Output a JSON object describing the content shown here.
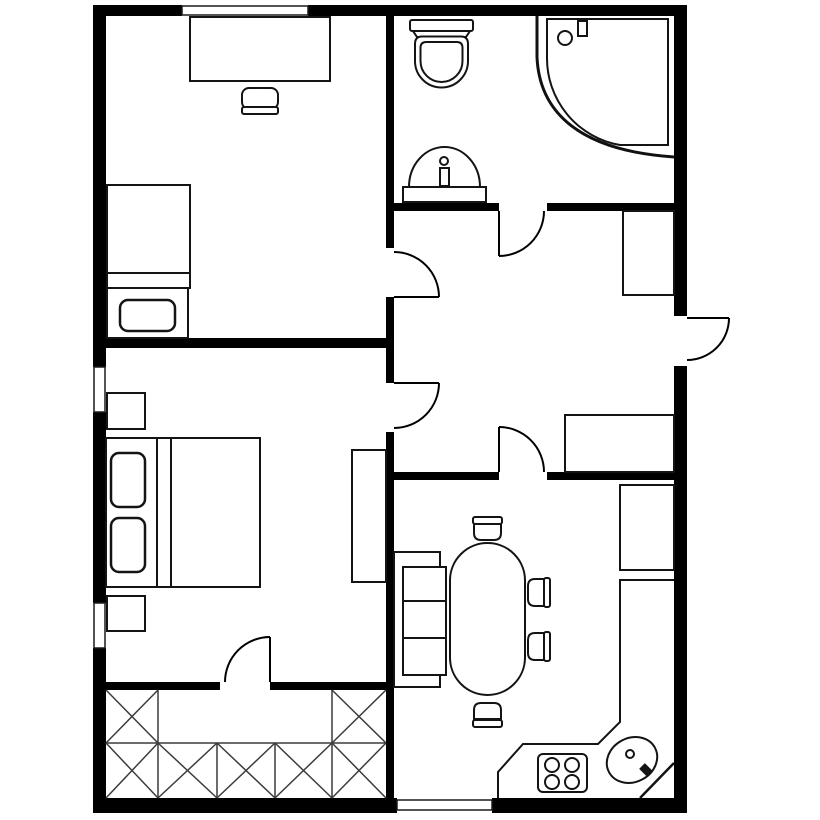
{
  "canvas": {
    "width": 820,
    "height": 820,
    "background": "#ffffff"
  },
  "colors": {
    "wall": "#000000",
    "line": "#141414",
    "hatch": "#3c3c3c",
    "floor": "#ffffff"
  },
  "styles": {
    "wall": {
      "fill": "#000000",
      "stroke": "none"
    },
    "window": {
      "fill": "#ffffff",
      "stroke": "#1a1a1a",
      "sw": 1.5
    },
    "door": {
      "fill": "none",
      "stroke": "#000000",
      "sw": 2
    },
    "furn": {
      "fill": "#ffffff",
      "stroke": "#141414",
      "sw": 2
    },
    "outline": {
      "fill": "none",
      "stroke": "#141414",
      "sw": 2
    },
    "pillow": {
      "fill": "#ffffff",
      "stroke": "#141414",
      "sw": 2.5
    },
    "screen": {
      "fill": "none",
      "stroke": "#111111",
      "sw": 3
    },
    "hatch": {
      "fill": "none",
      "stroke": "#3c3c3c",
      "sw": 1.5
    }
  },
  "shapes": [
    {
      "name": "top-wall-left",
      "type": "rect",
      "style": "wall",
      "x": 93,
      "y": 5,
      "w": 89,
      "h": 11
    },
    {
      "name": "top-wall-right",
      "type": "rect",
      "style": "wall",
      "x": 308,
      "y": 5,
      "w": 379,
      "h": 11
    },
    {
      "name": "bottom-wall-left",
      "type": "rect",
      "style": "wall",
      "x": 93,
      "y": 798,
      "w": 304,
      "h": 15
    },
    {
      "name": "bottom-wall-right",
      "type": "rect",
      "style": "wall",
      "x": 492,
      "y": 798,
      "w": 195,
      "h": 15
    },
    {
      "name": "left-wall-upper",
      "type": "rect",
      "style": "wall",
      "x": 93,
      "y": 5,
      "w": 13,
      "h": 362
    },
    {
      "name": "left-wall-middle",
      "type": "rect",
      "style": "wall",
      "x": 93,
      "y": 412,
      "w": 13,
      "h": 191
    },
    {
      "name": "left-wall-lower",
      "type": "rect",
      "style": "wall",
      "x": 93,
      "y": 648,
      "w": 13,
      "h": 165
    },
    {
      "name": "right-wall-upper",
      "type": "rect",
      "style": "wall",
      "x": 674,
      "y": 5,
      "w": 13,
      "h": 311
    },
    {
      "name": "right-wall-lower",
      "type": "rect",
      "style": "wall",
      "x": 674,
      "y": 366,
      "w": 13,
      "h": 447
    },
    {
      "name": "middle-wall-upper",
      "type": "rect",
      "style": "wall",
      "x": 386,
      "y": 16,
      "w": 8,
      "h": 232
    },
    {
      "name": "middle-wall-mid",
      "type": "rect",
      "style": "wall",
      "x": 386,
      "y": 297,
      "w": 8,
      "h": 86
    },
    {
      "name": "middle-wall-lower",
      "type": "rect",
      "style": "wall",
      "x": 386,
      "y": 432,
      "w": 8,
      "h": 366
    },
    {
      "name": "bedroom-divider-wall",
      "type": "rect",
      "style": "wall",
      "x": 106,
      "y": 338,
      "w": 280,
      "h": 10
    },
    {
      "name": "storage-wall-left",
      "type": "rect",
      "style": "wall",
      "x": 106,
      "y": 682,
      "w": 114,
      "h": 8
    },
    {
      "name": "storage-wall-right",
      "type": "rect",
      "style": "wall",
      "x": 270,
      "y": 682,
      "w": 116,
      "h": 8
    },
    {
      "name": "bathroom-wall-left",
      "type": "rect",
      "style": "wall",
      "x": 386,
      "y": 203,
      "w": 113,
      "h": 8
    },
    {
      "name": "bathroom-wall-right",
      "type": "rect",
      "style": "wall",
      "x": 547,
      "y": 203,
      "w": 127,
      "h": 8
    },
    {
      "name": "kitchen-wall-left",
      "type": "rect",
      "style": "wall",
      "x": 394,
      "y": 472,
      "w": 105,
      "h": 8
    },
    {
      "name": "kitchen-wall-right",
      "type": "rect",
      "style": "wall",
      "x": 547,
      "y": 472,
      "w": 127,
      "h": 8
    },
    {
      "name": "window-top",
      "type": "rect",
      "style": "window",
      "x": 182,
      "y": 6,
      "w": 126,
      "h": 9
    },
    {
      "name": "window-left-upper",
      "type": "rect",
      "style": "window",
      "x": 94,
      "y": 367,
      "w": 11,
      "h": 45
    },
    {
      "name": "window-left-lower",
      "type": "rect",
      "style": "window",
      "x": 94,
      "y": 603,
      "w": 11,
      "h": 45
    },
    {
      "name": "window-bottom",
      "type": "rect",
      "style": "window",
      "x": 397,
      "y": 800,
      "w": 95,
      "h": 10
    },
    {
      "name": "desk",
      "type": "rect",
      "style": "furn",
      "x": 190,
      "y": 17,
      "w": 140,
      "h": 64
    },
    {
      "name": "desk-chair-seat",
      "type": "rect",
      "style": "furn",
      "x": 242,
      "y": 88,
      "w": 36,
      "h": 21,
      "rx": 7
    },
    {
      "name": "desk-chair-back",
      "type": "rect",
      "style": "furn",
      "x": 242,
      "y": 107,
      "w": 36,
      "h": 7,
      "rx": 2
    },
    {
      "name": "single-bed-mattress",
      "type": "rect",
      "style": "furn",
      "x": 107,
      "y": 185,
      "w": 83,
      "h": 88
    },
    {
      "name": "single-bed-fold",
      "type": "rect",
      "style": "furn",
      "x": 107,
      "y": 273,
      "w": 83,
      "h": 15
    },
    {
      "name": "single-bed-head",
      "type": "rect",
      "style": "furn",
      "x": 107,
      "y": 288,
      "w": 81,
      "h": 50
    },
    {
      "name": "single-bed-pillow",
      "type": "rect",
      "style": "pillow",
      "x": 120,
      "y": 300,
      "w": 55,
      "h": 31,
      "rx": 8
    },
    {
      "name": "nightstand-1",
      "type": "rect",
      "style": "furn",
      "x": 107,
      "y": 393,
      "w": 38,
      "h": 36
    },
    {
      "name": "nightstand-2",
      "type": "rect",
      "style": "furn",
      "x": 107,
      "y": 596,
      "w": 38,
      "h": 35
    },
    {
      "name": "double-bed-frame",
      "type": "rect",
      "style": "furn",
      "x": 106,
      "y": 438,
      "w": 154,
      "h": 149
    },
    {
      "name": "double-bed-pillow-1",
      "type": "rect",
      "style": "pillow",
      "x": 111,
      "y": 453,
      "w": 34,
      "h": 54,
      "rx": 8
    },
    {
      "name": "double-bed-pillow-2",
      "type": "rect",
      "style": "pillow",
      "x": 111,
      "y": 518,
      "w": 34,
      "h": 54,
      "rx": 8
    },
    {
      "name": "double-bed-fold-line-1",
      "type": "line",
      "style": "outline",
      "x1": 157,
      "y1": 438,
      "x2": 157,
      "y2": 587
    },
    {
      "name": "double-bed-fold-line-2",
      "type": "line",
      "style": "outline",
      "x1": 171,
      "y1": 438,
      "x2": 171,
      "y2": 587
    },
    {
      "name": "wardrobe",
      "type": "rect",
      "style": "furn",
      "x": 352,
      "y": 450,
      "w": 34,
      "h": 132
    },
    {
      "name": "toilet-tank",
      "type": "rect",
      "style": "furn",
      "x": 410,
      "y": 20,
      "w": 63,
      "h": 11,
      "rx": 2
    },
    {
      "name": "toilet-neck",
      "type": "path",
      "style": "furn",
      "d": "M413,31 L470,31 L466,37 L417,37 Z"
    },
    {
      "name": "toilet-bowl-outer",
      "type": "path",
      "style": "furn",
      "d": "M415,44 Q415,36.5 422,36.5 L461,36.5 Q468,36.5 468,44 L468,61 A26.5,26.5 0 0 1 415,61 Z"
    },
    {
      "name": "toilet-bowl-inner",
      "type": "path",
      "style": "furn",
      "d": "M420.5,48 Q420.5,42 426,42 L457,42 Q462.5,42 462.5,48 L462.5,61 A21,21 0 0 1 420.5,61 Z"
    },
    {
      "name": "bathroom-sink-bowl",
      "type": "path",
      "style": "furn",
      "d": "M409,187 A35.5,40 0 0 1 480,187 Z"
    },
    {
      "name": "bathroom-sink-base",
      "type": "rect",
      "style": "furn",
      "x": 403,
      "y": 187,
      "w": 83,
      "h": 15
    },
    {
      "name": "bathroom-sink-drain",
      "type": "circle",
      "style": "furn",
      "cx": 444,
      "cy": 161,
      "r": 4
    },
    {
      "name": "bathroom-sink-faucet",
      "type": "rect",
      "style": "furn",
      "x": 440,
      "y": 168,
      "w": 9,
      "h": 18
    },
    {
      "name": "shower-screen-side",
      "type": "line",
      "style": "screen",
      "x1": 537,
      "y1": 16,
      "x2": 537,
      "y2": 57
    },
    {
      "name": "shower-screen-arc",
      "type": "path",
      "style": "screen",
      "d": "M537,57 C539,105 570,150 674,157"
    },
    {
      "name": "shower-tray",
      "type": "path",
      "style": "furn",
      "d": "M547,19 L547,57 A88,88 0 0 0 620,145 L668,145 L668,19 Z"
    },
    {
      "name": "shower-drain",
      "type": "circle",
      "style": "furn",
      "cx": 565,
      "cy": 38,
      "r": 7
    },
    {
      "name": "shower-handle",
      "type": "rect",
      "style": "furn",
      "x": 578,
      "y": 21,
      "w": 9,
      "h": 15
    },
    {
      "name": "hall-closet-1",
      "type": "rect",
      "style": "furn",
      "x": 623,
      "y": 211,
      "w": 51,
      "h": 84
    },
    {
      "name": "hall-closet-2",
      "type": "rect",
      "style": "furn",
      "x": 565,
      "y": 415,
      "w": 109,
      "h": 57
    },
    {
      "name": "sofa-back",
      "type": "rect",
      "style": "furn",
      "x": 394,
      "y": 552,
      "w": 46,
      "h": 135
    },
    {
      "name": "sofa-seat",
      "type": "rect",
      "style": "furn",
      "x": 403,
      "y": 567,
      "w": 43,
      "h": 108
    },
    {
      "name": "sofa-cushion-line-1",
      "type": "line",
      "style": "outline",
      "x1": 403,
      "y1": 601,
      "x2": 446,
      "y2": 601
    },
    {
      "name": "sofa-cushion-line-2",
      "type": "line",
      "style": "outline",
      "x1": 403,
      "y1": 638,
      "x2": 446,
      "y2": 638
    },
    {
      "name": "dining-table",
      "type": "rect",
      "style": "furn",
      "x": 450,
      "y": 543,
      "w": 75,
      "h": 152,
      "rx": 37.5
    },
    {
      "name": "chair-top-back",
      "type": "rect",
      "style": "furn",
      "x": 473,
      "y": 517,
      "w": 29,
      "h": 7,
      "rx": 2
    },
    {
      "name": "chair-top-seat",
      "type": "path",
      "style": "furn",
      "d": "M474,524 h27 v9 q0,7 -7,7 h-13 q-7,0 -7,-7 Z"
    },
    {
      "name": "chair-right-1-back",
      "type": "rect",
      "style": "furn",
      "x": 544,
      "y": 578,
      "w": 6,
      "h": 29,
      "rx": 2
    },
    {
      "name": "chair-right-1-seat",
      "type": "path",
      "style": "furn",
      "d": "M544,579 v27 h-9 q-7,0 -7,-7 v-13 q0,-7 7,-7 Z"
    },
    {
      "name": "chair-right-2-back",
      "type": "rect",
      "style": "furn",
      "x": 544,
      "y": 632,
      "w": 6,
      "h": 29,
      "rx": 2
    },
    {
      "name": "chair-right-2-seat",
      "type": "path",
      "style": "furn",
      "d": "M544,633 v27 h-9 q-7,0 -7,-7 v-13 q0,-7 7,-7 Z"
    },
    {
      "name": "chair-bottom-back",
      "type": "rect",
      "style": "furn",
      "x": 473,
      "y": 720,
      "w": 29,
      "h": 7,
      "rx": 2
    },
    {
      "name": "chair-bottom-seat",
      "type": "path",
      "style": "furn",
      "d": "M474,719 v-9 q0,-7 7,-7 h13 q7,0 7,7 v9 Z"
    },
    {
      "name": "kitchen-counter-upper",
      "type": "rect",
      "style": "furn",
      "x": 620,
      "y": 485,
      "w": 54,
      "h": 85
    },
    {
      "name": "kitchen-counter-edge",
      "type": "path",
      "style": "outline",
      "d": "M674,580 L620,580 L620,722 L598,744 L523,744 L498,772 L498,798"
    },
    {
      "name": "kitchen-corner-diagonal",
      "type": "line",
      "style": "outline",
      "x1": 640,
      "y1": 798,
      "x2": 674,
      "y2": 763,
      "sw": 2.5
    },
    {
      "name": "stove",
      "type": "rect",
      "style": "furn",
      "x": 538,
      "y": 754,
      "w": 49,
      "h": 38,
      "rx": 5
    },
    {
      "name": "stove-burner-1",
      "type": "circle",
      "style": "furn",
      "cx": 552,
      "cy": 765,
      "r": 7
    },
    {
      "name": "stove-burner-2",
      "type": "circle",
      "style": "furn",
      "cx": 572,
      "cy": 765,
      "r": 7
    },
    {
      "name": "stove-burner-3",
      "type": "circle",
      "style": "furn",
      "cx": 552,
      "cy": 782,
      "r": 7
    },
    {
      "name": "stove-burner-4",
      "type": "circle",
      "style": "furn",
      "cx": 572,
      "cy": 782,
      "r": 7
    },
    {
      "name": "kitchen-sink",
      "type": "ellipse",
      "style": "furn",
      "cx": 632,
      "cy": 760,
      "rx": 26,
      "ry": 22,
      "rot": -28
    },
    {
      "name": "kitchen-sink-drain",
      "type": "circle",
      "style": "furn",
      "cx": 630,
      "cy": 754,
      "r": 4
    },
    {
      "name": "kitchen-sink-faucet",
      "type": "line",
      "style": "outline",
      "x1": 642,
      "y1": 766,
      "x2": 650,
      "y2": 774,
      "sw": 8
    },
    {
      "name": "storage-grid-lines",
      "type": "lines",
      "style": "hatch",
      "segs": [
        [
          106,
          743,
          386,
          743
        ],
        [
          158,
          690,
          158,
          798
        ],
        [
          217,
          743,
          217,
          798
        ],
        [
          275,
          743,
          275,
          798
        ],
        [
          332,
          690,
          332,
          798
        ]
      ]
    },
    {
      "name": "storage-hatch-x",
      "type": "lines",
      "style": "hatch",
      "segs": [
        [
          106,
          690,
          158,
          743
        ],
        [
          158,
          690,
          106,
          743
        ],
        [
          332,
          690,
          386,
          743
        ],
        [
          386,
          690,
          332,
          743
        ],
        [
          106,
          743,
          158,
          798
        ],
        [
          158,
          743,
          106,
          798
        ],
        [
          158,
          743,
          217,
          798
        ],
        [
          217,
          743,
          158,
          798
        ],
        [
          217,
          743,
          275,
          798
        ],
        [
          275,
          743,
          217,
          798
        ],
        [
          275,
          743,
          332,
          798
        ],
        [
          332,
          743,
          275,
          798
        ],
        [
          332,
          743,
          386,
          798
        ],
        [
          386,
          743,
          332,
          798
        ]
      ]
    },
    {
      "name": "bedroom1-door-leaf",
      "type": "line",
      "style": "door",
      "x1": 394,
      "y1": 297,
      "x2": 439,
      "y2": 297
    },
    {
      "name": "bedroom1-door-arc",
      "type": "path",
      "style": "door",
      "d": "M394,252 A45,45 0 0 1 439,297"
    },
    {
      "name": "bedroom2-door-leaf",
      "type": "line",
      "style": "door",
      "x1": 394,
      "y1": 383,
      "x2": 439,
      "y2": 383
    },
    {
      "name": "bedroom2-door-arc",
      "type": "path",
      "style": "door",
      "d": "M439,383 A45,45 0 0 1 394,428"
    },
    {
      "name": "bathroom-door-leaf",
      "type": "line",
      "style": "door",
      "x1": 499,
      "y1": 211,
      "x2": 499,
      "y2": 256
    },
    {
      "name": "bathroom-door-arc",
      "type": "path",
      "style": "door",
      "d": "M499,256 A45,45 0 0 0 544,211"
    },
    {
      "name": "kitchen-door-leaf",
      "type": "line",
      "style": "door",
      "x1": 499,
      "y1": 427,
      "x2": 499,
      "y2": 472
    },
    {
      "name": "kitchen-door-arc",
      "type": "path",
      "style": "door",
      "d": "M499,427 A45,45 0 0 1 544,472"
    },
    {
      "name": "storage-door-leaf",
      "type": "line",
      "style": "door",
      "x1": 270,
      "y1": 637,
      "x2": 270,
      "y2": 682
    },
    {
      "name": "storage-door-arc",
      "type": "path",
      "style": "door",
      "d": "M270,637 A45,45 0 0 0 225,682"
    },
    {
      "name": "entry-door-leaf",
      "type": "line",
      "style": "door",
      "x1": 687,
      "y1": 318,
      "x2": 729,
      "y2": 318
    },
    {
      "name": "entry-door-arc",
      "type": "path",
      "style": "door",
      "d": "M729,318 A42,42 0 0 1 687,360"
    }
  ]
}
